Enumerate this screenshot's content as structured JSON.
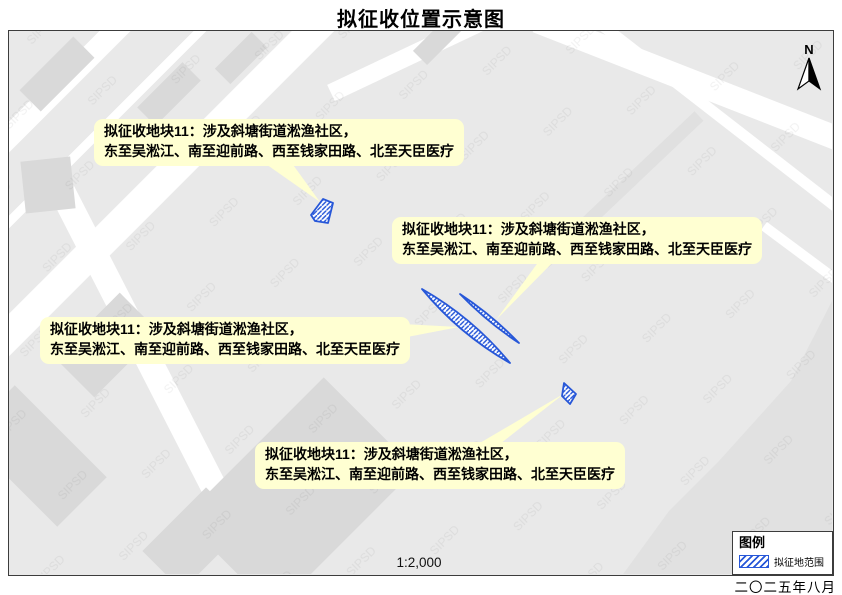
{
  "title": "拟征收位置示意图",
  "map": {
    "watermark": "SIPSD",
    "north_label": "N",
    "scale_text": "1:2,000"
  },
  "callouts": [
    {
      "line1": "拟征收地块11：涉及斜塘街道淞渔社区，",
      "line2": "东至吴淞江、南至迎前路、西至钱家田路、北至天臣医疗"
    },
    {
      "line1": "拟征收地块11：涉及斜塘街道淞渔社区，",
      "line2": "东至吴淞江、南至迎前路、西至钱家田路、北至天臣医疗"
    },
    {
      "line1": "拟征收地块11：涉及斜塘街道淞渔社区，",
      "line2": "东至吴淞江、南至迎前路、西至钱家田路、北至天臣医疗"
    },
    {
      "line1": "拟征收地块11：涉及斜塘街道淞渔社区，",
      "line2": "东至吴淞江、南至迎前路、西至钱家田路、北至天臣医疗"
    }
  ],
  "legend": {
    "title": "图例",
    "items": [
      {
        "label": "拟征地范围",
        "swatch": "blue-diagonal-hatch"
      }
    ]
  },
  "footer": {
    "date": "二〇二五年八月"
  },
  "colors": {
    "parcel_blue": "#2757D8",
    "callout_yellow": "#FFFFD2",
    "map_gray": "#e9e9e9",
    "building_gray": "#d9d9d9"
  }
}
